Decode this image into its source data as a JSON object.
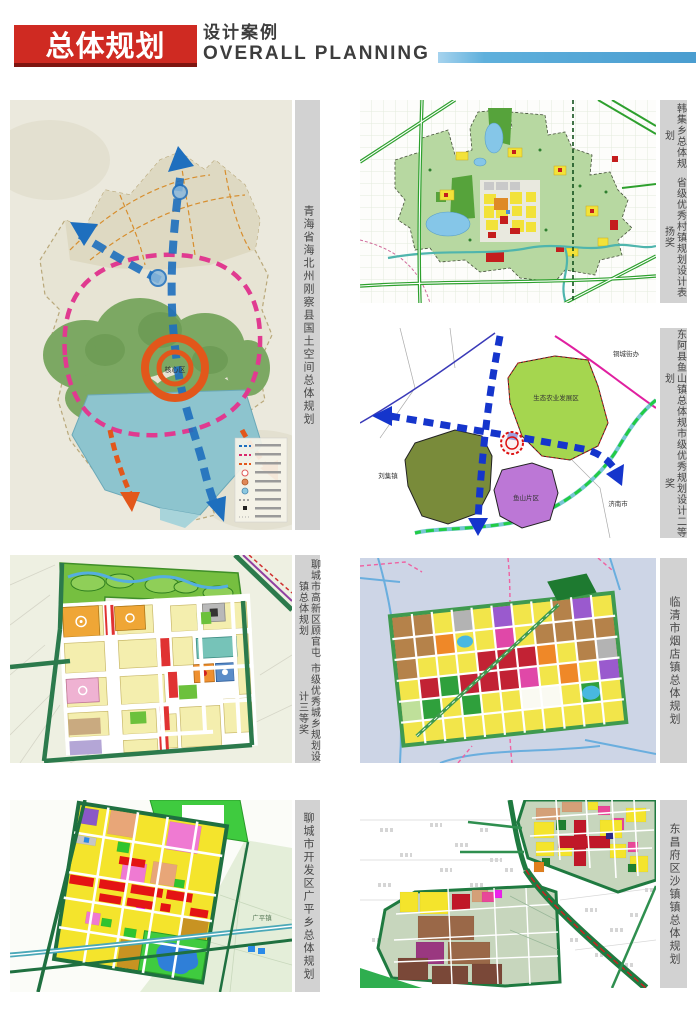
{
  "header": {
    "badge": "总体规划",
    "subtitle_cn": "设计案例",
    "subtitle_en": "OVERALL PLANNING"
  },
  "colors": {
    "badge_bg": "#cf2a22",
    "badge_shadow": "#7e1510",
    "accent_bar": "#4a9dd0",
    "caption_bg": "#d2d2d2",
    "caption_text": "#464646"
  },
  "panels": [
    {
      "title": "青海省海北州刚察县国土空间总体规划",
      "award": ""
    },
    {
      "title": "韩集乡总体规划",
      "award": "省级优秀村镇规划设计表扬奖"
    },
    {
      "title": "东阿县鱼山镇总体规划",
      "award": "市级优秀规划设计二等奖"
    },
    {
      "title": "聊城市高新区顾官屯镇总体规划",
      "award": "市级优秀城乡规划设计三等奖"
    },
    {
      "title": "临清市烟店镇总体规划",
      "award": ""
    },
    {
      "title": "聊城市开发区广平乡总体规划",
      "award": ""
    },
    {
      "title": "东昌府区沙镇镇总体规划",
      "award": ""
    }
  ],
  "map_labels": {
    "map1_core": "核心区",
    "map3_eco": "生态农业发展区",
    "map3_yushan": "鱼山片区",
    "map3_liuji": "刘集镇",
    "map3_jinan": "济南市",
    "map3_tongcheng": "铜城街办",
    "map6_guangping": "广平镇"
  }
}
